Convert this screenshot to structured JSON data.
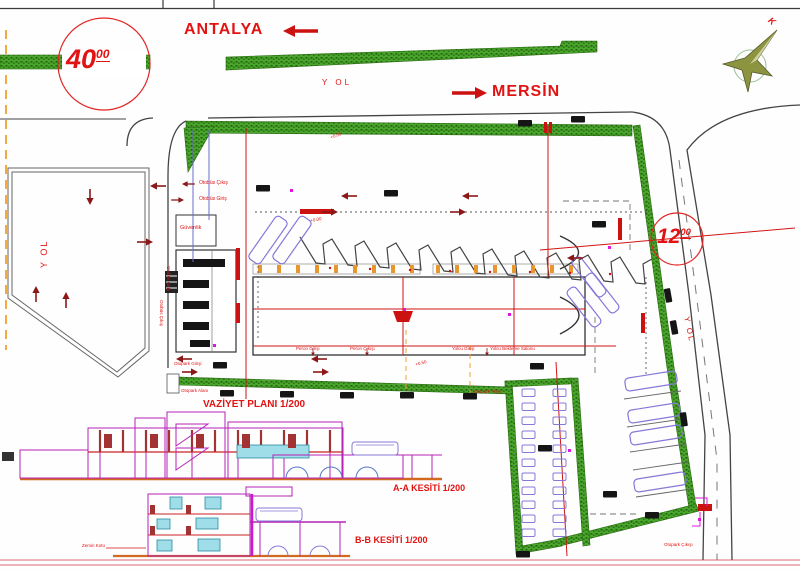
{
  "roads": {
    "antalya": "ANTALYA",
    "mersin": "MERSİN",
    "yol_top": "Y OL",
    "yol_left": "Y OL",
    "yol_right": "Y OL"
  },
  "dims": {
    "w40": "40",
    "w40_sup": "00",
    "w12": "12",
    "w12_sup": "00"
  },
  "north": {
    "k": "K"
  },
  "plan": {
    "guvenlik": "Güvenlik",
    "otobus_cikis": "Otobüs Çıkış",
    "otobus_giris": "Otobüs Giriş",
    "otobus_giris_v": "Otobüs Giriş",
    "otobus_cikis_v": "Otobüs Çıkış",
    "otopark_girisi": "Otopark Girişi",
    "otopark_cikisi": "Otopark Çıkışı",
    "otopark_alani_l": "Otopark Alanı",
    "otopark_alani_r": "Otopark Alanı",
    "zemin_kotu": "Zemin Kotu",
    "gates": [
      "Peron Girişi",
      "Peron Çıkışı",
      "Yolcu Girişi",
      "Yolcu Bekleme Salonu"
    ],
    "levels": [
      {
        "text": "+0.00"
      },
      {
        "text": "+0.00"
      },
      {
        "text": "+0.50"
      }
    ]
  },
  "titles": {
    "vaziyet": "VAZİYET PLANI 1/200",
    "kesit_aa": "A-A KESİTİ 1/200",
    "kesit_bb": "B-B KESİTİ 1/200"
  },
  "colors": {
    "hedge_green": "#4aa52c",
    "label_red": "#e21313",
    "axis_red": "#d11414",
    "arrow_maroon": "#8b1717",
    "stall_purple": "#8678d8",
    "magenta": "#e016e0",
    "column_orange": "#e8962e",
    "window_cyan": "#9fdde8",
    "section_magenta": "#b523b5",
    "sheet_pink": "#e89aa0"
  }
}
